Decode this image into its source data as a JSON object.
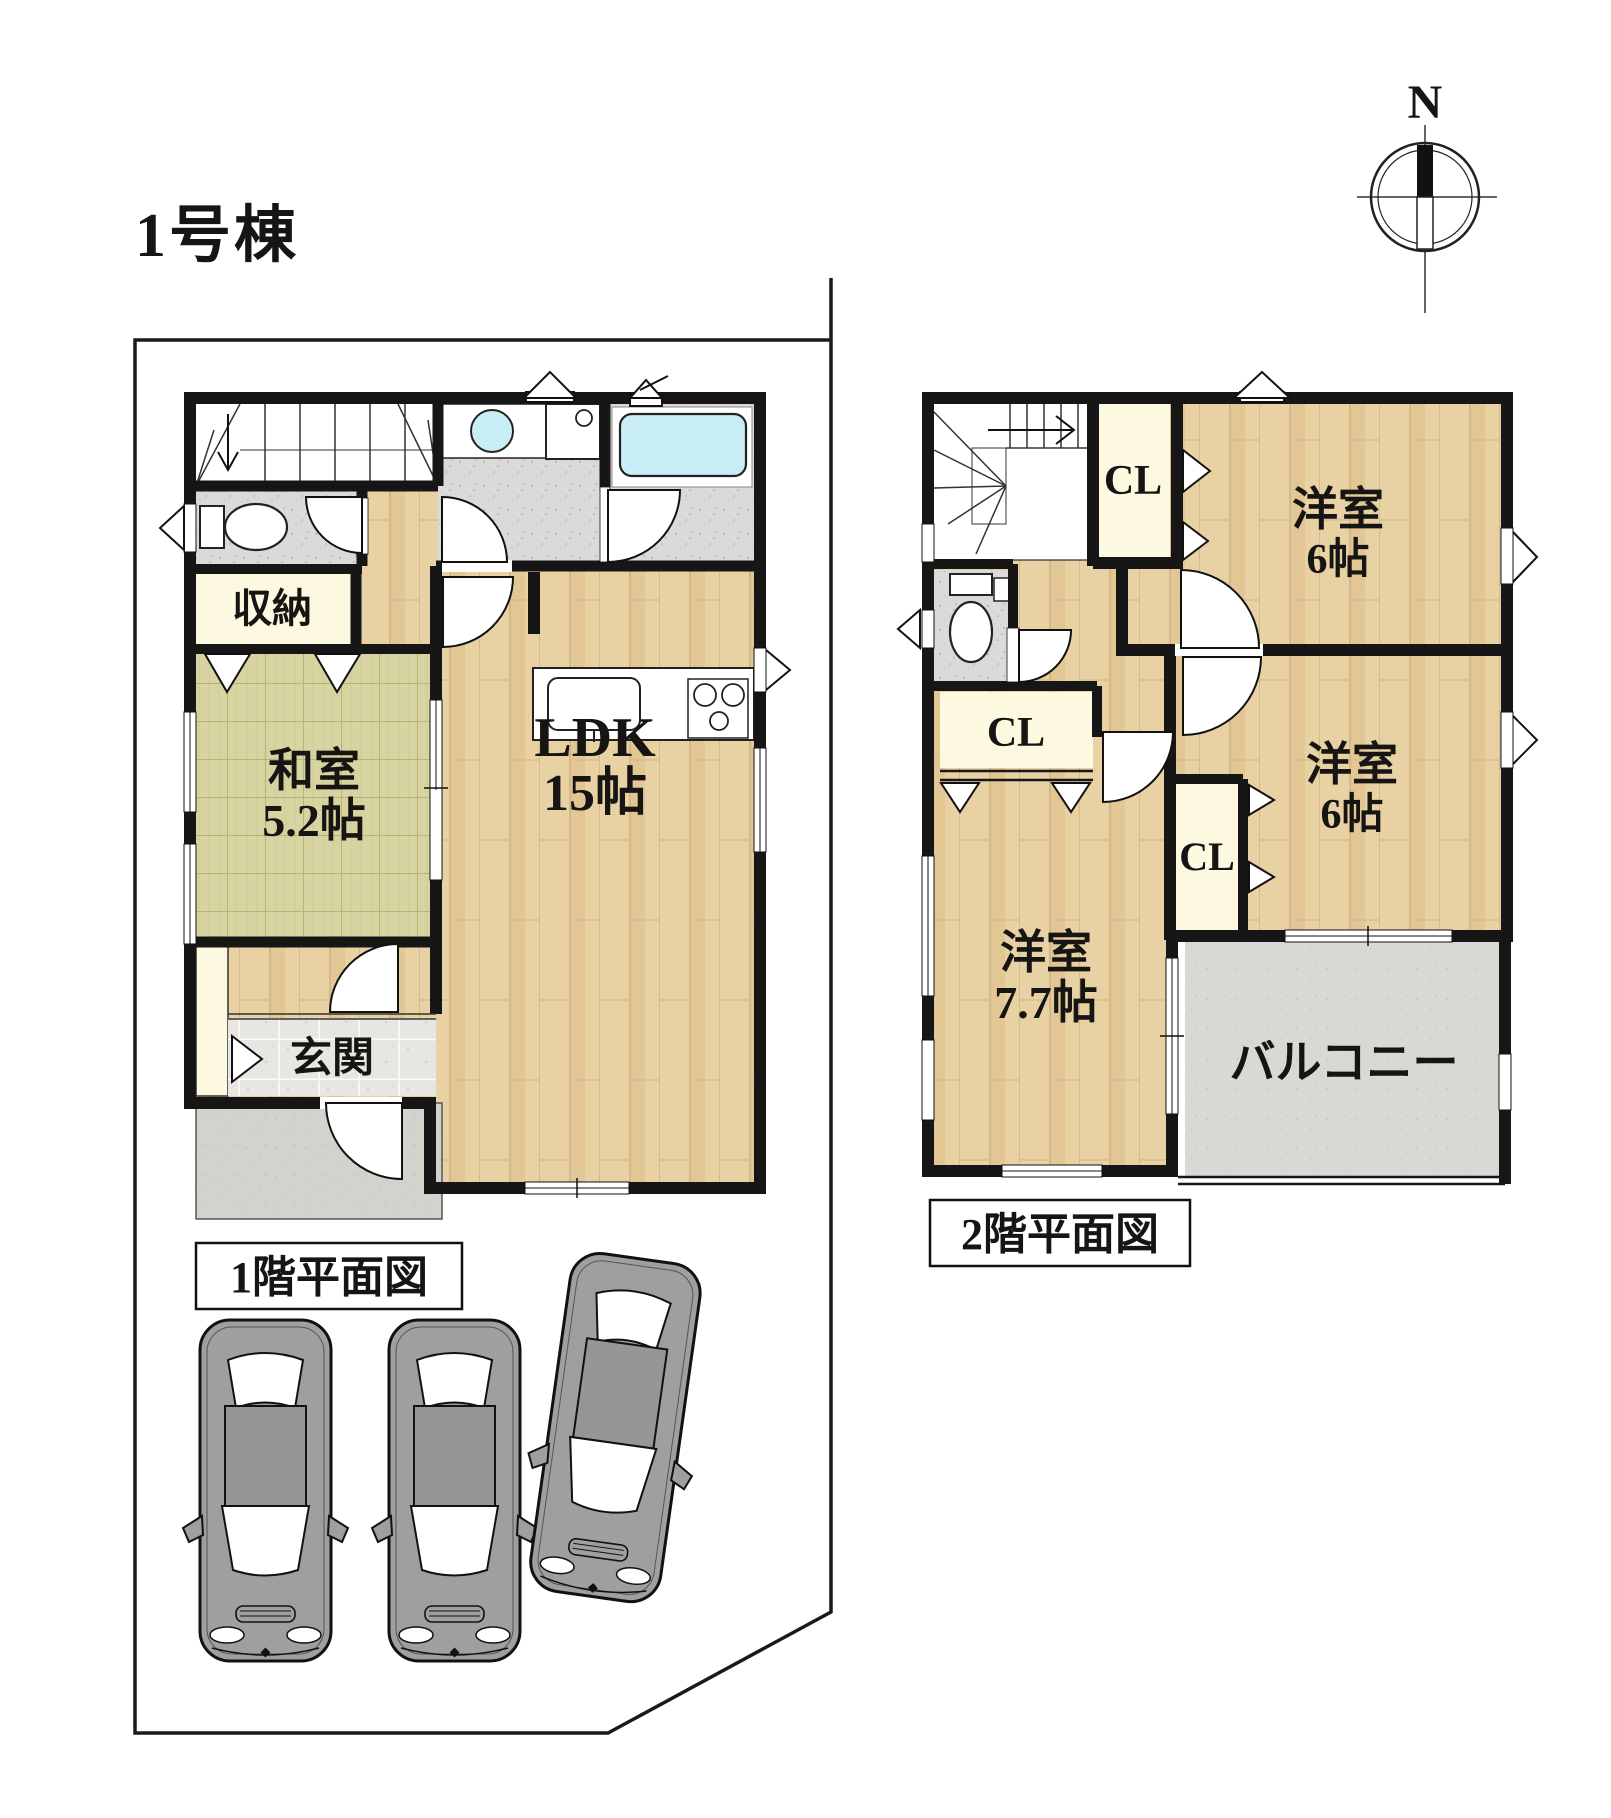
{
  "title": "1号棟",
  "compass": {
    "north": "N"
  },
  "floor1": {
    "caption": "1階平面図",
    "storage": "収納",
    "washitsu": {
      "name": "和室",
      "size": "5.2帖"
    },
    "ldk": {
      "name": "LDK",
      "size": "15帖"
    },
    "genkan": "玄関"
  },
  "floor2": {
    "caption": "2階平面図",
    "closet1": "CL",
    "closet2": "CL",
    "closet3": "CL",
    "bedroom1": {
      "name": "洋室",
      "size": "6帖"
    },
    "bedroom2": {
      "name": "洋室",
      "size": "6帖"
    },
    "bedroom3": {
      "name": "洋室",
      "size": "7.7帖"
    },
    "balcony": "バルコニー"
  },
  "colors": {
    "wall": "#161616",
    "wood": "#e8d1a3",
    "tatami": "#d7d4a1",
    "cream": "#fdf9e0",
    "water": "#c8edf4",
    "tile_gray": "#dbdad8",
    "concrete": "#d3d2cc"
  }
}
